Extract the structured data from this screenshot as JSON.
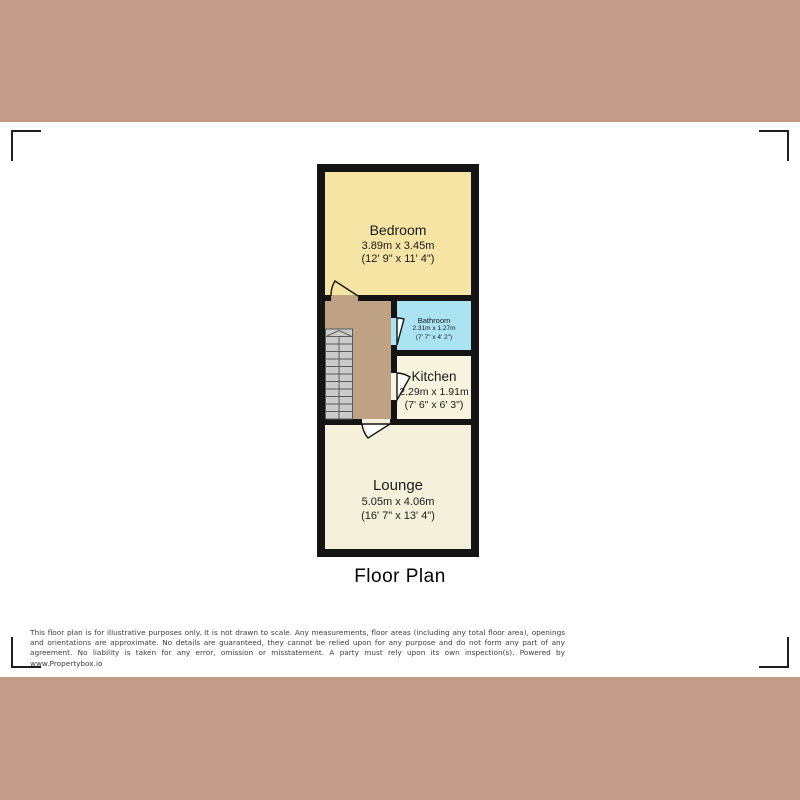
{
  "page": {
    "band_color": "#c49a88",
    "background_color": "#ffffff",
    "wall_color": "#141414"
  },
  "floor_plan": {
    "title": "Floor Plan",
    "hallway_color": "#bfa284",
    "stairs_color": "#cbcbcb",
    "rooms": [
      {
        "name": "Bedroom",
        "metric": "3.89m x 3.45m",
        "imperial": "(12' 9\" x 11' 4\")",
        "color": "#f5e4a4"
      },
      {
        "name": "Bathroom",
        "metric": "2.31m x 1.27m",
        "imperial": "(7' 7\" x 4' 2\")",
        "color": "#aae3f2"
      },
      {
        "name": "Kitchen",
        "metric": "2.29m x 1.91m",
        "imperial": "(7' 6\" x 6' 3\")",
        "color": "#f8f3dd"
      },
      {
        "name": "Lounge",
        "metric": "5.05m x 4.06m",
        "imperial": "(16' 7\" x 13' 4\")",
        "color": "#f5f0d9"
      }
    ]
  },
  "disclaimer": {
    "text": "This floor plan is for illustrative purposes only. It is not drawn to scale. Any measurements, floor areas (including any total floor area), openings and orientations are approximate. No details are guaranteed, they cannot be relied upon for any purpose and do not form any part of any agreement. No liability is taken for any error, omission or misstatement. A party must rely upon its own inspection(s). Powered by www.Propertybox.io"
  }
}
